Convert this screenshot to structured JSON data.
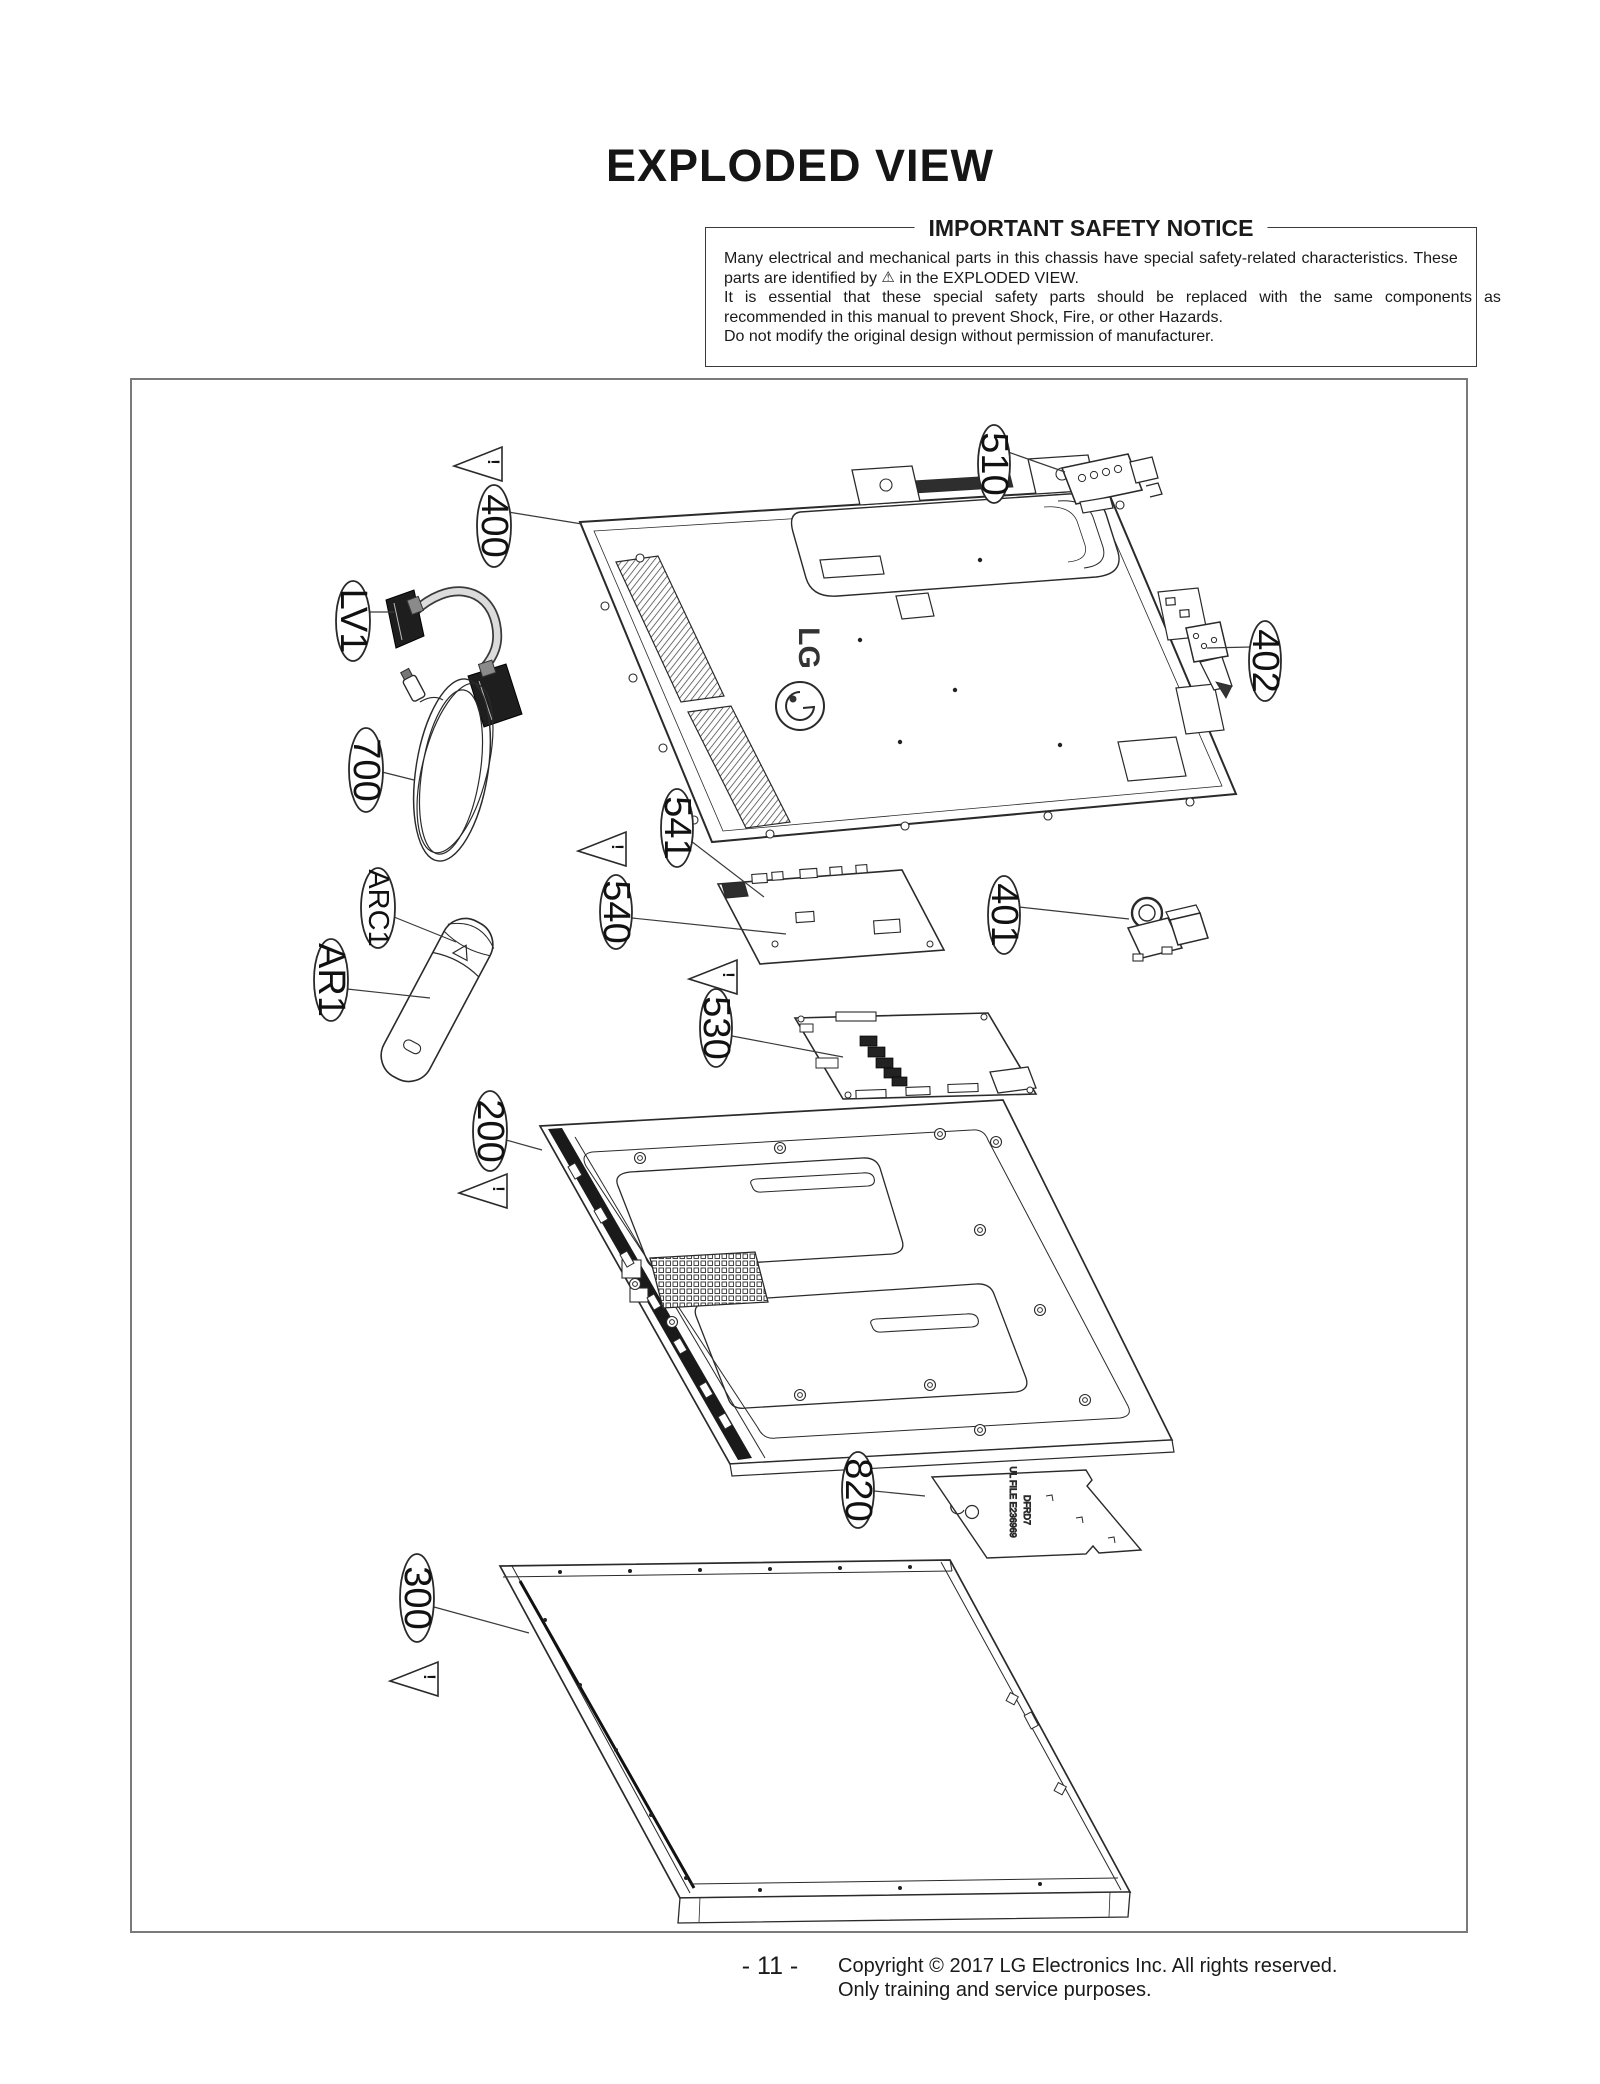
{
  "page": {
    "title": "EXPLODED VIEW",
    "page_number": "- 11 -",
    "copyright_line1": "Copyright © 2017 LG Electronics Inc. All rights reserved.",
    "copyright_line2": "Only training and service purposes."
  },
  "safety_notice": {
    "heading": "IMPORTANT SAFETY NOTICE",
    "line1": "Many electrical and mechanical parts in this chassis have special safety-related characteristics. These",
    "line2_before": "parts are identified by ",
    "warning_symbol": "⚠",
    "line2_after": " in the EXPLODED VIEW.",
    "line3": "It is essential that these special safety parts should be replaced with the same components as",
    "line4": "recommended in this manual to prevent Shock, Fire, or other Hazards.",
    "line5": "Do not modify the original design without permission of manufacturer."
  },
  "diagram": {
    "labels": [
      {
        "text": "400"
      },
      {
        "text": "510"
      },
      {
        "text": "402"
      },
      {
        "text": "LV1"
      },
      {
        "text": "700"
      },
      {
        "text": "ARC1"
      },
      {
        "text": "AR1"
      },
      {
        "text": "541"
      },
      {
        "text": "540"
      },
      {
        "text": "530"
      },
      {
        "text": "401"
      },
      {
        "text": "200"
      },
      {
        "text": "820"
      },
      {
        "text": "300"
      }
    ],
    "warning_mark": "!",
    "cover_logo": "LG",
    "sheet_text_1": "UL FILE E236969",
    "sheet_text_2": "DFRD7"
  }
}
